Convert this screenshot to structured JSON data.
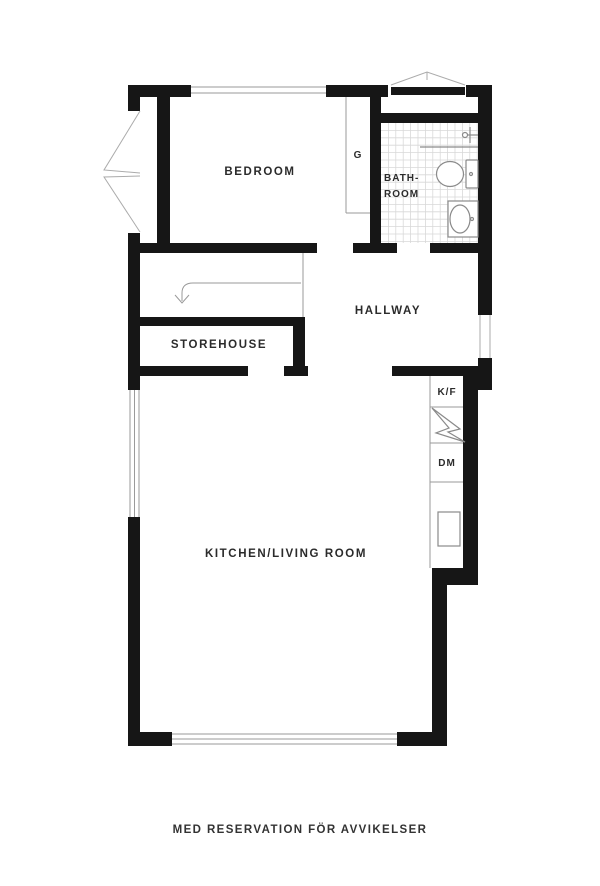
{
  "plan": {
    "rooms": {
      "bedroom": "BEDROOM",
      "bathroom_line1": "BATH-",
      "bathroom_line2": "ROOM",
      "hallway": "HALLWAY",
      "storehouse": "STOREHOUSE",
      "kitchen_living": "KITCHEN/LIVING ROOM"
    },
    "fixtures": {
      "closet": "G",
      "fridge_freezer": "K/F",
      "dishwasher": "DM"
    },
    "caption": "MED RESERVATION FÖR AVVIKELSER",
    "colors": {
      "wall": "#161616",
      "thin_line": "#9a9a9a",
      "tile_line": "#d8d8d8",
      "text": "#2b2b2b"
    }
  }
}
